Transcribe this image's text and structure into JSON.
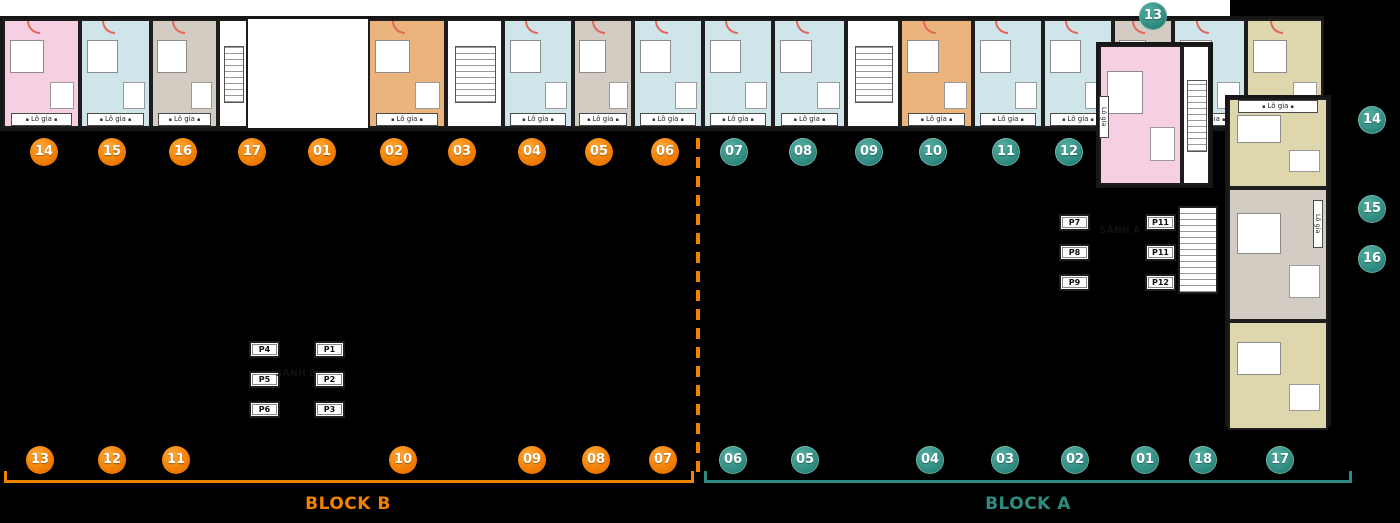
{
  "labels": {
    "block_b": "BLOCK B",
    "block_a": "BLOCK A",
    "lobby_a": "SẢNH A",
    "lobby_b": "SẢNH B",
    "balcony": "Lô gia"
  },
  "accents": {
    "orange": "#F08300",
    "teal": "#2E8B80"
  },
  "palette": {
    "pink": "#F6D0E2",
    "blue": "#CFE5E9",
    "taupe": "#D3CCC3",
    "orange_unit": "#EAB47C",
    "khaki": "#DED6AD",
    "wall": "#161616",
    "door_arc": "#E2685E"
  },
  "badges": [
    {
      "n": "14",
      "group": "top",
      "color": "orange",
      "x": 44,
      "y": 152
    },
    {
      "n": "15",
      "group": "top",
      "color": "orange",
      "x": 112,
      "y": 152
    },
    {
      "n": "16",
      "group": "top",
      "color": "orange",
      "x": 183,
      "y": 152
    },
    {
      "n": "17",
      "group": "top",
      "color": "orange",
      "x": 252,
      "y": 152
    },
    {
      "n": "01",
      "group": "top",
      "color": "orange",
      "x": 322,
      "y": 152
    },
    {
      "n": "02",
      "group": "top",
      "color": "orange",
      "x": 394,
      "y": 152
    },
    {
      "n": "03",
      "group": "top",
      "color": "orange",
      "x": 462,
      "y": 152
    },
    {
      "n": "04",
      "group": "top",
      "color": "orange",
      "x": 532,
      "y": 152
    },
    {
      "n": "05",
      "group": "top",
      "color": "orange",
      "x": 599,
      "y": 152
    },
    {
      "n": "06",
      "group": "top",
      "color": "orange",
      "x": 665,
      "y": 152
    },
    {
      "n": "07",
      "group": "top",
      "color": "teal",
      "x": 734,
      "y": 152
    },
    {
      "n": "08",
      "group": "top",
      "color": "teal",
      "x": 803,
      "y": 152
    },
    {
      "n": "09",
      "group": "top",
      "color": "teal",
      "x": 869,
      "y": 152
    },
    {
      "n": "10",
      "group": "top",
      "color": "teal",
      "x": 933,
      "y": 152
    },
    {
      "n": "11",
      "group": "top",
      "color": "teal",
      "x": 1006,
      "y": 152
    },
    {
      "n": "12",
      "group": "top",
      "color": "teal",
      "x": 1069,
      "y": 152
    },
    {
      "n": "13",
      "group": "tower",
      "color": "teal",
      "x": 1153,
      "y": 16
    },
    {
      "n": "14",
      "group": "right",
      "color": "teal",
      "x": 1372,
      "y": 120
    },
    {
      "n": "15",
      "group": "right",
      "color": "teal",
      "x": 1372,
      "y": 209
    },
    {
      "n": "16",
      "group": "right",
      "color": "teal",
      "x": 1372,
      "y": 259
    },
    {
      "n": "13",
      "group": "bottom",
      "color": "orange",
      "x": 40,
      "y": 460
    },
    {
      "n": "12",
      "group": "bottom",
      "color": "orange",
      "x": 112,
      "y": 460
    },
    {
      "n": "11",
      "group": "bottom",
      "color": "orange",
      "x": 176,
      "y": 460
    },
    {
      "n": "10",
      "group": "bottom",
      "color": "orange",
      "x": 403,
      "y": 460
    },
    {
      "n": "09",
      "group": "bottom",
      "color": "orange",
      "x": 532,
      "y": 460
    },
    {
      "n": "08",
      "group": "bottom",
      "color": "orange",
      "x": 596,
      "y": 460
    },
    {
      "n": "07",
      "group": "bottom",
      "color": "orange",
      "x": 663,
      "y": 460
    },
    {
      "n": "06",
      "group": "bottom",
      "color": "teal",
      "x": 733,
      "y": 460
    },
    {
      "n": "05",
      "group": "bottom",
      "color": "teal",
      "x": 805,
      "y": 460
    },
    {
      "n": "04",
      "group": "bottom",
      "color": "teal",
      "x": 930,
      "y": 460
    },
    {
      "n": "03",
      "group": "bottom",
      "color": "teal",
      "x": 1005,
      "y": 460
    },
    {
      "n": "02",
      "group": "bottom",
      "color": "teal",
      "x": 1075,
      "y": 460
    },
    {
      "n": "01",
      "group": "bottom",
      "color": "teal",
      "x": 1145,
      "y": 460
    },
    {
      "n": "18",
      "group": "bottom",
      "color": "teal",
      "x": 1203,
      "y": 460
    },
    {
      "n": "17",
      "group": "bottom",
      "color": "teal",
      "x": 1280,
      "y": 460
    }
  ],
  "lifts": [
    {
      "el": "lifts-b-left",
      "items": [
        "P4",
        "P5",
        "P6"
      ]
    },
    {
      "el": "lifts-b-right",
      "items": [
        "P1",
        "P2",
        "P3"
      ]
    },
    {
      "el": "lifts-a-left",
      "items": [
        "P7",
        "P8",
        "P9"
      ]
    },
    {
      "el": "lifts-a-right",
      "items": [
        "P11",
        "P11",
        "P12"
      ]
    }
  ],
  "wings": {
    "top-wing": {
      "balcony_side": "top",
      "units": [
        {
          "x": 0,
          "w": 77,
          "c": "pink"
        },
        {
          "x": 77,
          "w": 71,
          "c": "blue"
        },
        {
          "x": 148,
          "w": 71,
          "c": "blue"
        },
        {
          "x": 219,
          "w": 72,
          "c": "blue"
        },
        {
          "x": 291,
          "w": 72,
          "c": "blue"
        },
        {
          "x": 363,
          "w": 72,
          "c": "blue"
        },
        {
          "x": 435,
          "w": 72,
          "c": "blue"
        },
        {
          "x": 507,
          "w": 63,
          "c": "blue"
        },
        {
          "x": 570,
          "w": 60,
          "c": "taupe"
        },
        {
          "x": 630,
          "w": 70,
          "c": "blue"
        },
        {
          "x": 700,
          "w": 70,
          "c": "blue"
        },
        {
          "x": 770,
          "w": 70,
          "c": "blue"
        },
        {
          "x": 840,
          "w": 57,
          "c": "taupe"
        },
        {
          "x": 897,
          "w": 70,
          "c": "blue"
        },
        {
          "x": 967,
          "w": 73,
          "c": "blue"
        }
      ]
    },
    "bottom-wing": {
      "balcony_side": "bottom",
      "units": [
        {
          "x": 0,
          "w": 77,
          "c": "pink"
        },
        {
          "x": 77,
          "w": 71,
          "c": "blue"
        },
        {
          "x": 148,
          "w": 67,
          "c": "taupe"
        },
        {
          "x": 215,
          "w": 30,
          "c": "stair"
        },
        {
          "x": 365,
          "w": 78,
          "c": "orange_unit"
        },
        {
          "x": 443,
          "w": 57,
          "c": "stair"
        },
        {
          "x": 500,
          "w": 70,
          "c": "blue"
        },
        {
          "x": 570,
          "w": 60,
          "c": "taupe"
        },
        {
          "x": 630,
          "w": 70,
          "c": "blue"
        },
        {
          "x": 700,
          "w": 70,
          "c": "blue"
        },
        {
          "x": 770,
          "w": 73,
          "c": "blue"
        },
        {
          "x": 843,
          "w": 54,
          "c": "stair"
        },
        {
          "x": 897,
          "w": 73,
          "c": "orange_unit"
        },
        {
          "x": 970,
          "w": 70,
          "c": "blue"
        },
        {
          "x": 1040,
          "w": 70,
          "c": "blue"
        },
        {
          "x": 1110,
          "w": 60,
          "c": "taupe"
        },
        {
          "x": 1170,
          "w": 73,
          "c": "blue"
        },
        {
          "x": 1243,
          "w": 77,
          "c": "khaki"
        }
      ]
    },
    "right-wing": {
      "balcony_side": "none",
      "units": [
        {
          "y": 0,
          "h": 90,
          "c": "khaki",
          "strip": "top"
        },
        {
          "y": 90,
          "h": 133,
          "c": "taupe"
        },
        {
          "y": 223,
          "h": 109,
          "c": "khaki"
        }
      ]
    },
    "tower": {
      "balcony_side": "none",
      "units": [
        {
          "x": 0,
          "w": 83,
          "c": "pink"
        },
        {
          "x": 83,
          "w": 28,
          "c": "stair"
        }
      ]
    }
  }
}
